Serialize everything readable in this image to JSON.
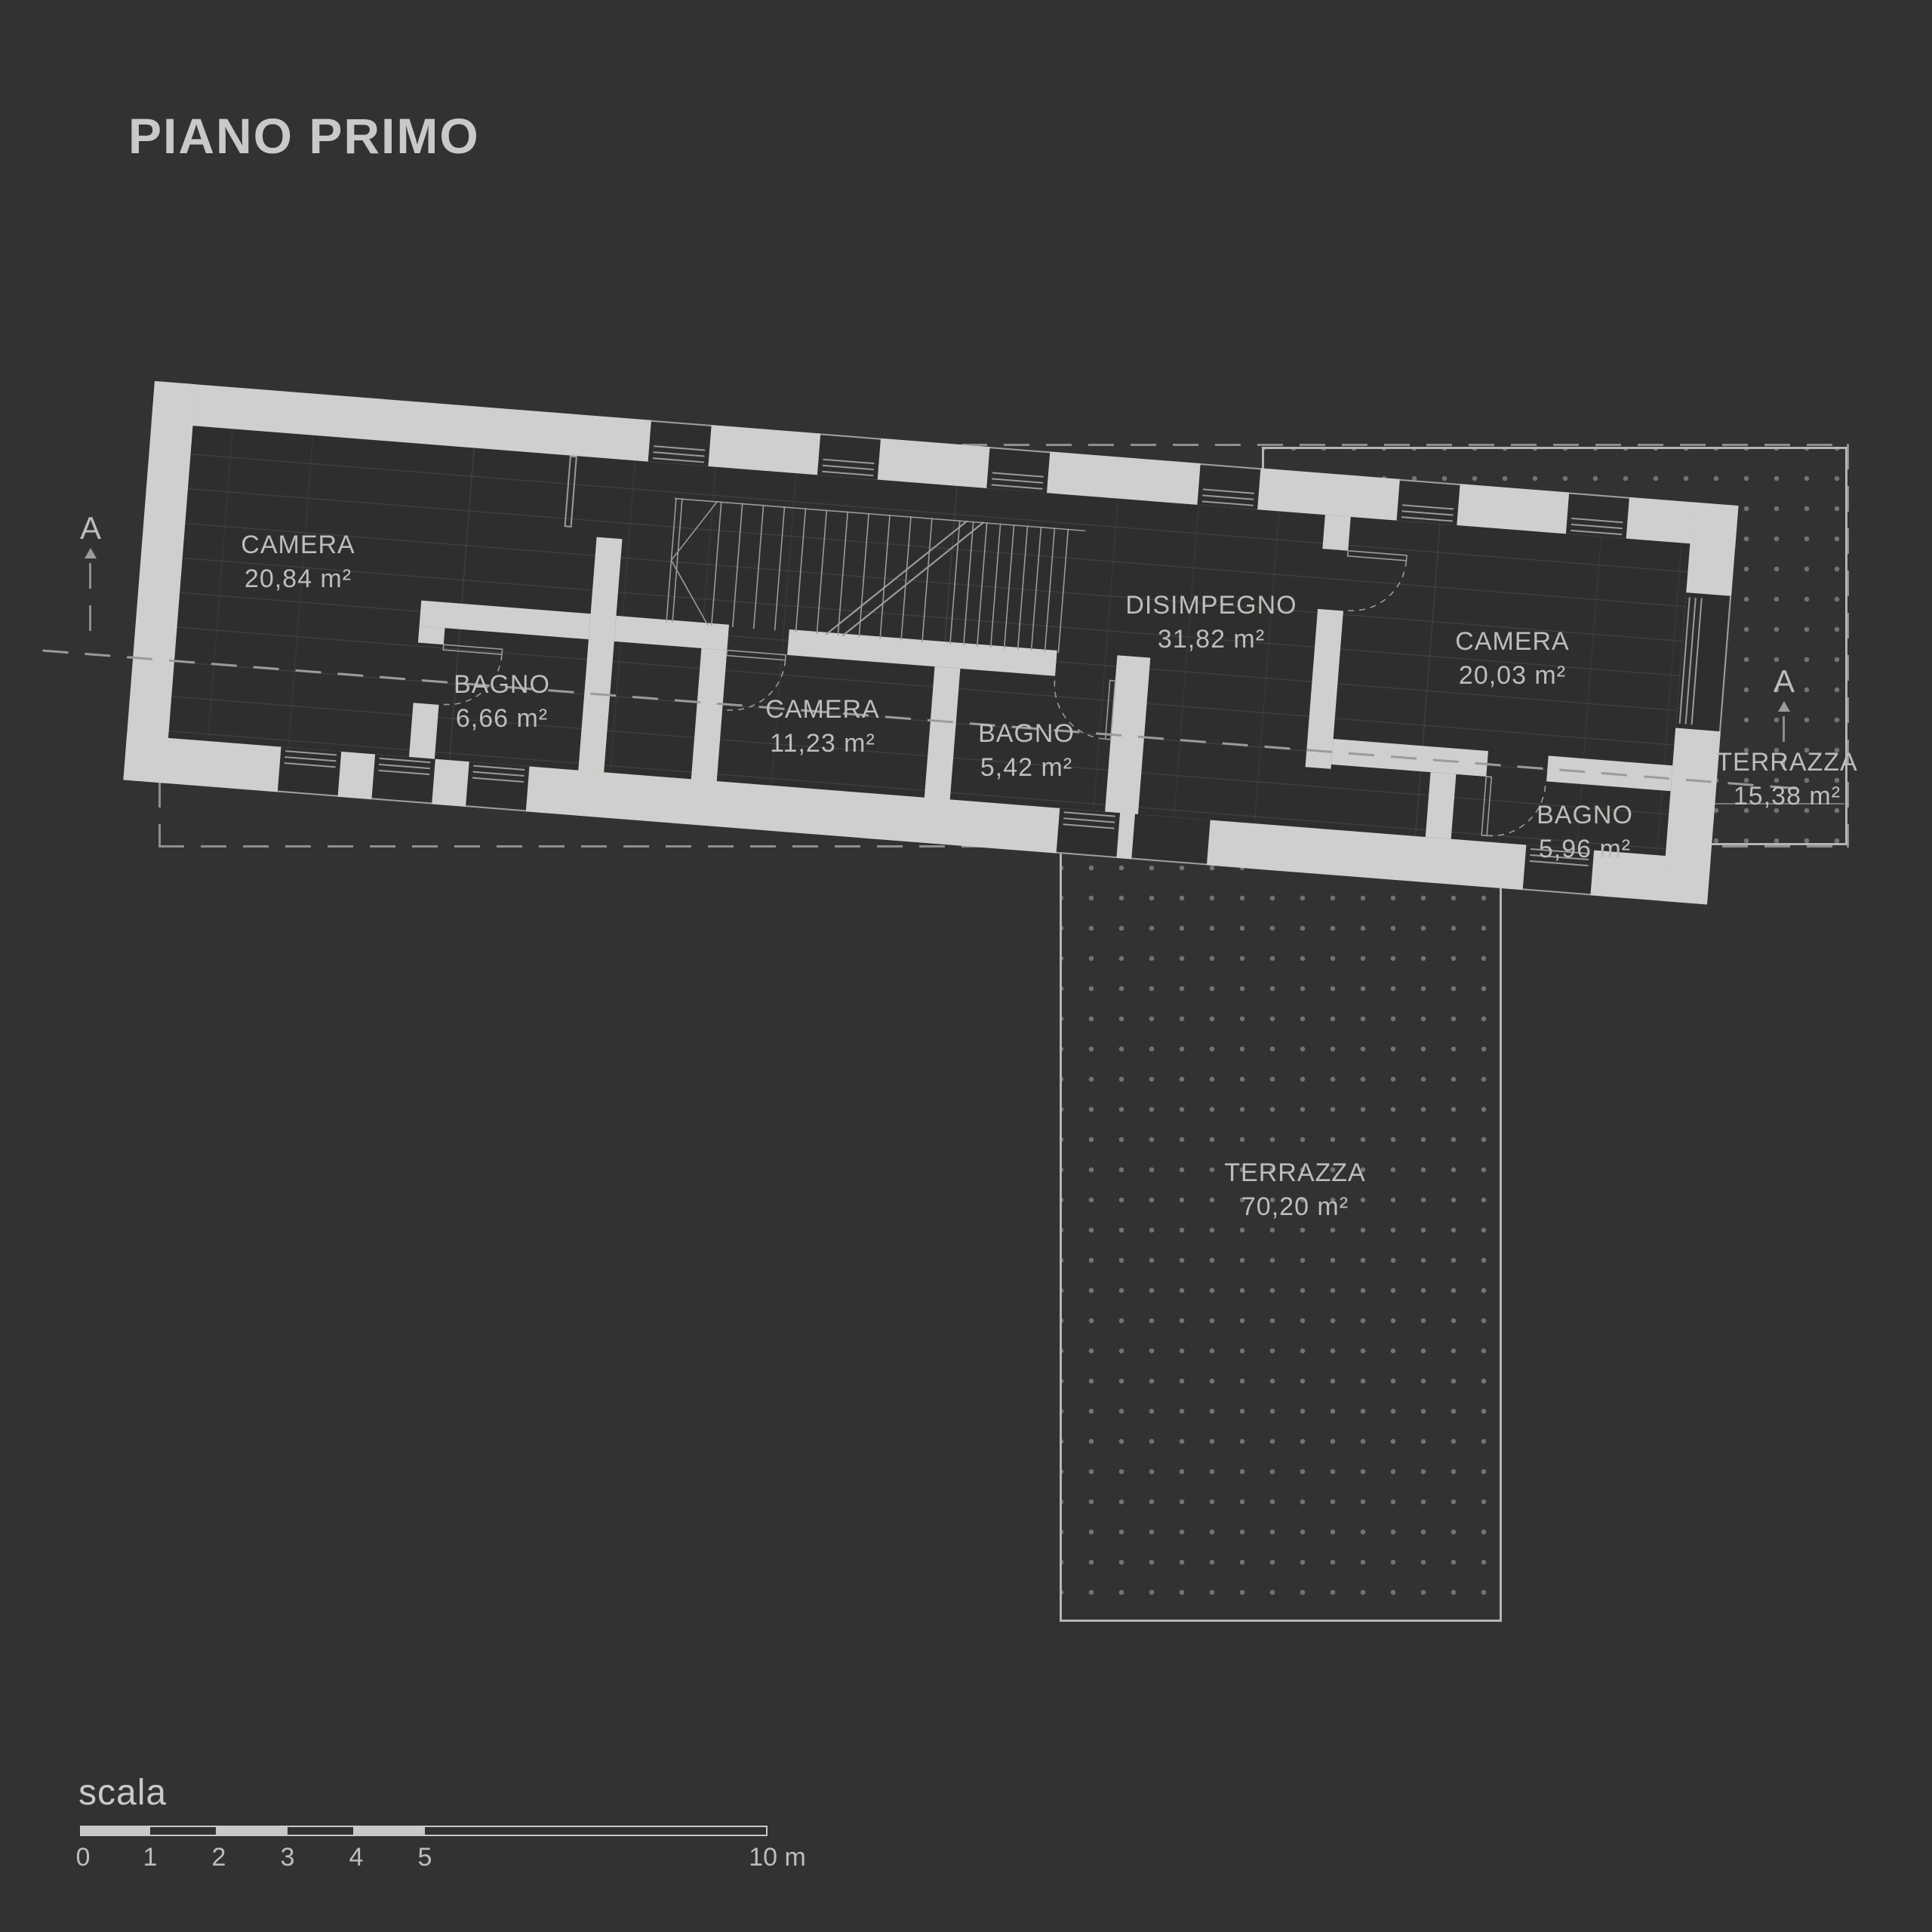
{
  "title": "PIANO PRIMO",
  "floor_plan": {
    "rooms": [
      {
        "id": "camera-1",
        "name": "CAMERA",
        "area": "20,84 m²"
      },
      {
        "id": "bagno-1",
        "name": "BAGNO",
        "area": "6,66 m²"
      },
      {
        "id": "camera-2",
        "name": "CAMERA",
        "area": "11,23 m²"
      },
      {
        "id": "bagno-2",
        "name": "BAGNO",
        "area": "5,42 m²"
      },
      {
        "id": "disimpegno",
        "name": "DISIMPEGNO",
        "area": "31,82 m²"
      },
      {
        "id": "camera-3",
        "name": "CAMERA",
        "area": "20,03 m²"
      },
      {
        "id": "bagno-3",
        "name": "BAGNO",
        "area": "5,96 m²"
      },
      {
        "id": "terrazza-1",
        "name": "TERRAZZA",
        "area": "15,38 m²"
      },
      {
        "id": "terrazza-2",
        "name": "TERRAZZA",
        "area": "70,20 m²"
      }
    ],
    "section_markers": {
      "left": "A",
      "right": "A"
    }
  },
  "scale": {
    "label": "scala",
    "ticks": [
      "0",
      "1",
      "2",
      "3",
      "4",
      "5"
    ],
    "end": "10 m"
  },
  "colors": {
    "background": "#333231",
    "walls": "#cfcfcd",
    "text": "#bdbdbb",
    "lines": "#9b9b99"
  }
}
